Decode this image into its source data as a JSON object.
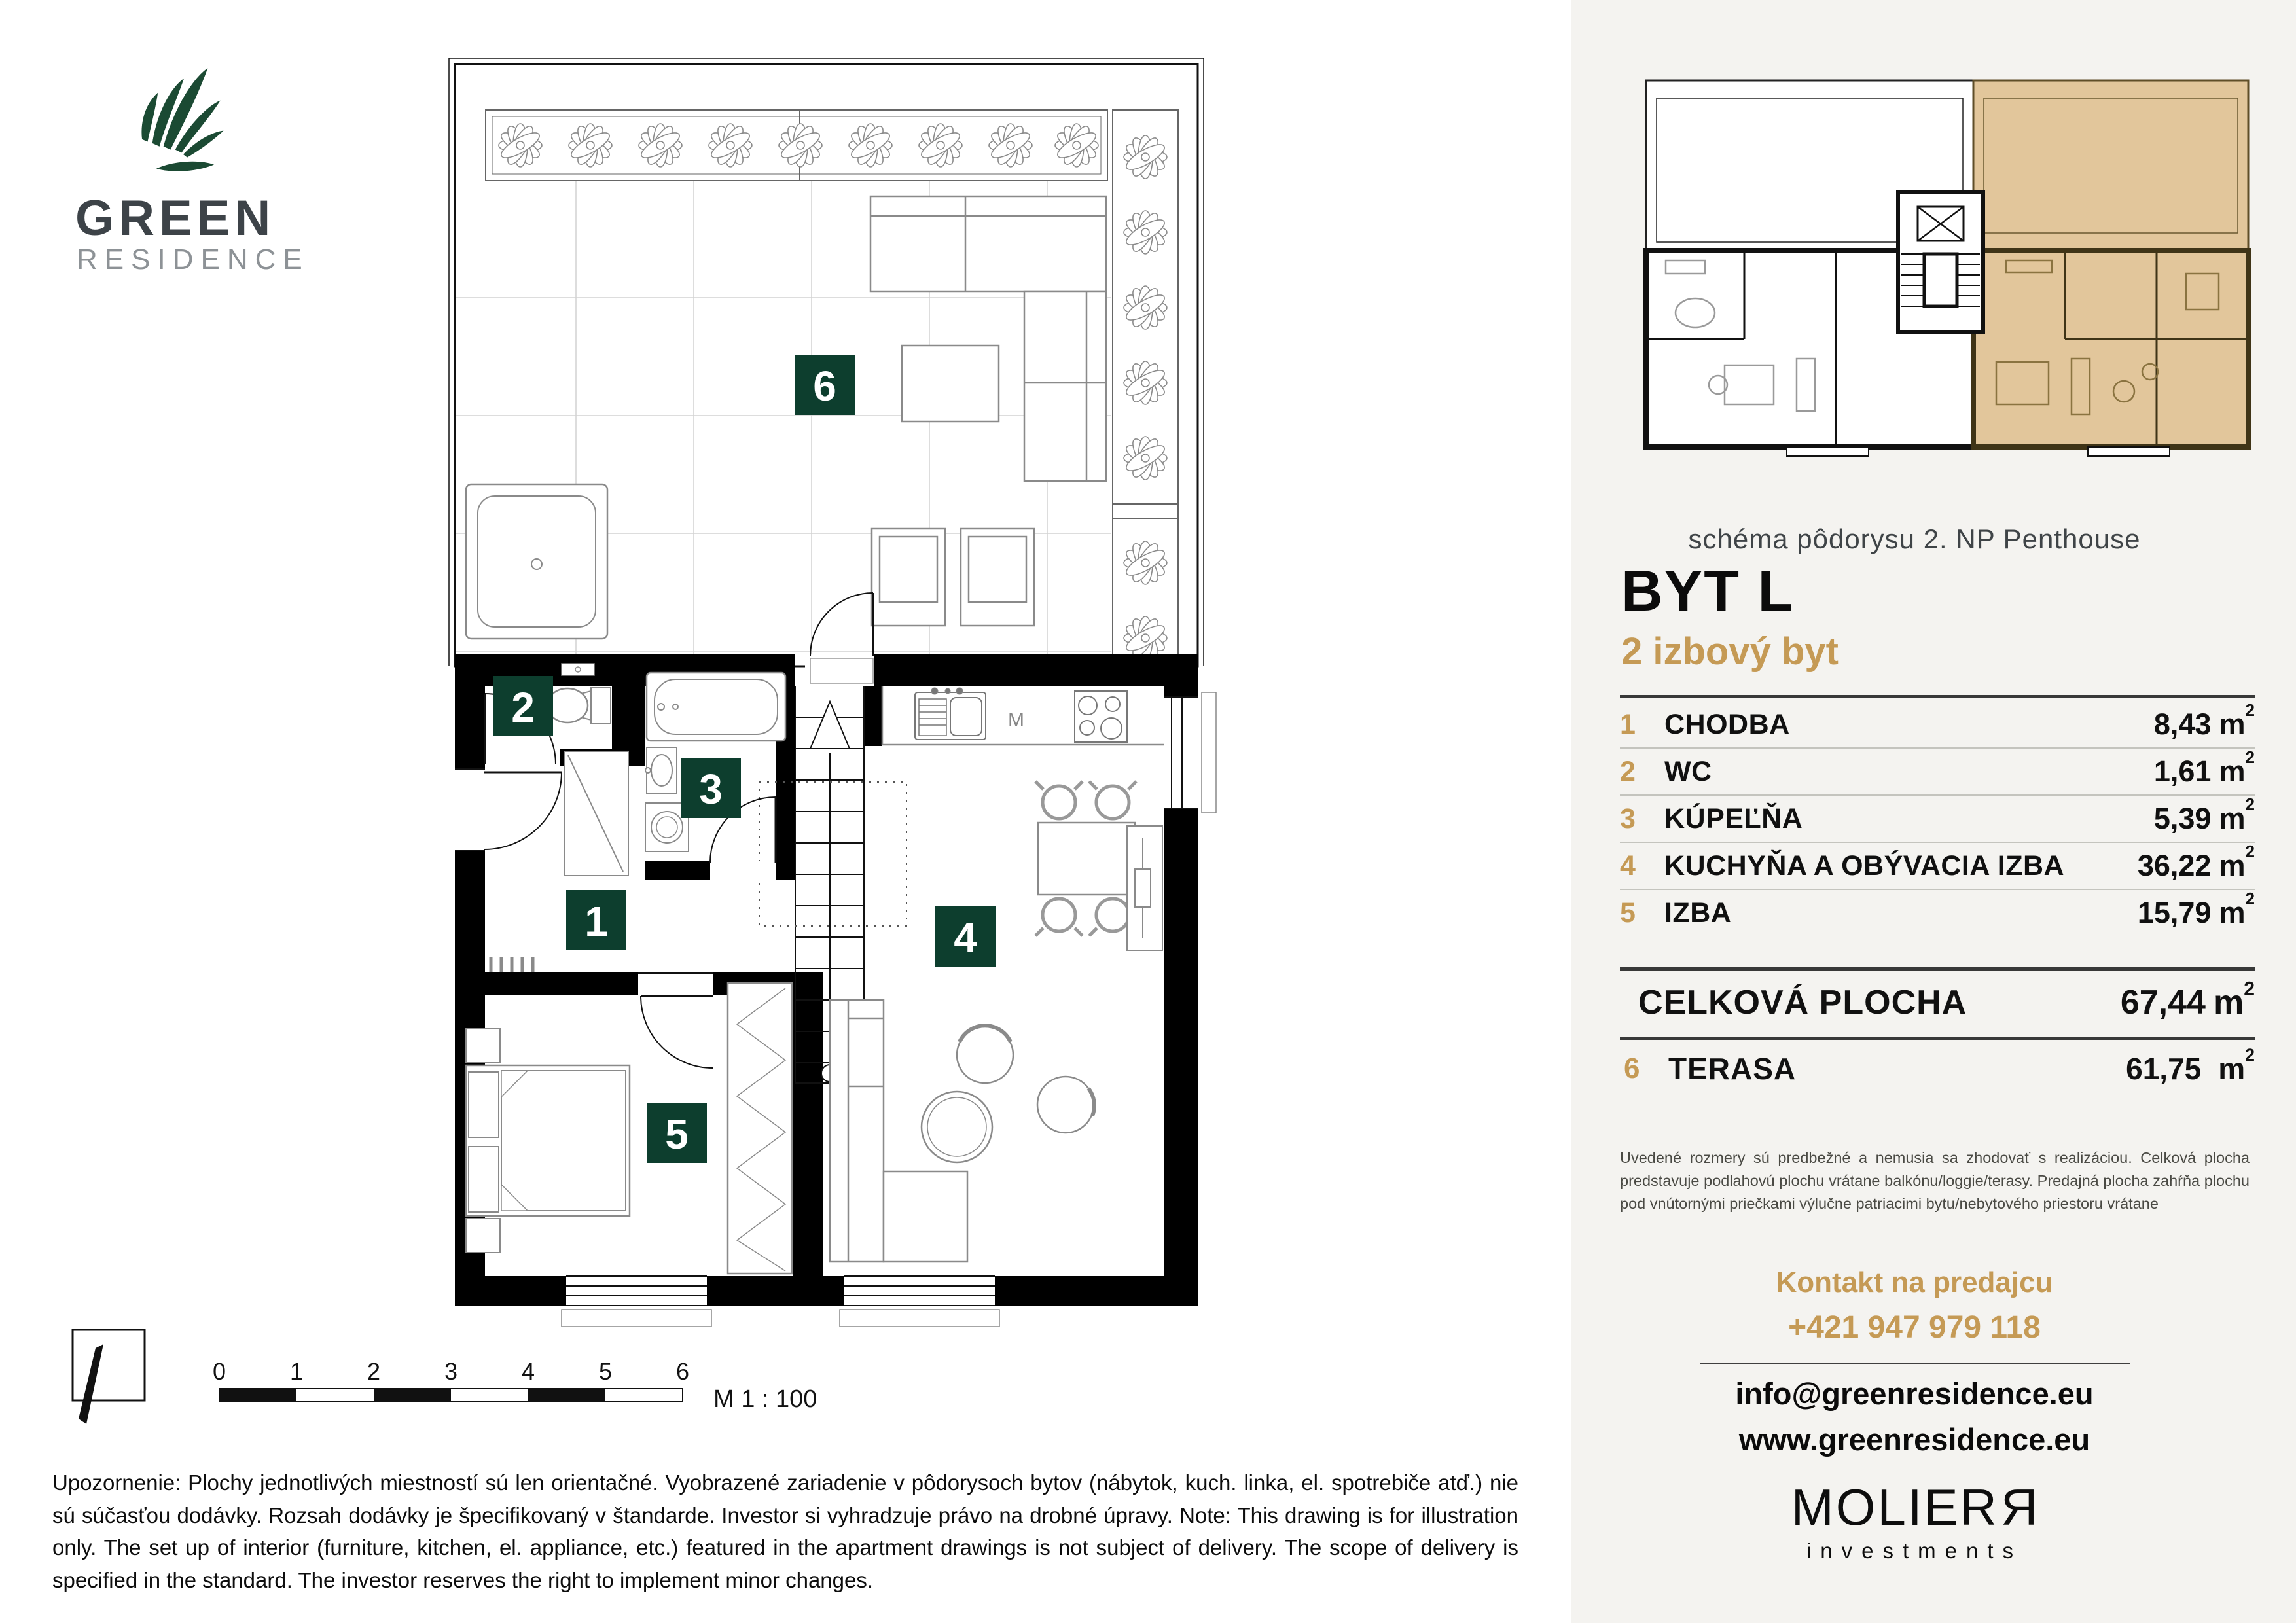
{
  "logo": {
    "line1": "GREEN",
    "line2": "RESIDENCE"
  },
  "minimap": {
    "caption": "schéma pôdorysu 2. NP Penthouse"
  },
  "unit": {
    "title": "BYT L",
    "subtitle": "2 izbový byt"
  },
  "legend": {
    "rooms": [
      {
        "no": "1",
        "label": "CHODBA",
        "value": "8,43"
      },
      {
        "no": "2",
        "label": "WC",
        "value": "1,61"
      },
      {
        "no": "3",
        "label": "KÚPEĽŇA",
        "value": "5,39"
      },
      {
        "no": "4",
        "label": "KUCHYŇA A OBÝVACIA IZBA",
        "value": "36,22"
      },
      {
        "no": "5",
        "label": "IZBA",
        "value": "15,79"
      }
    ],
    "total": {
      "label": "CELKOVÁ PLOCHA",
      "value": "67,44"
    },
    "terrace": {
      "no": "6",
      "label": "TERASA",
      "value": "61,75"
    },
    "unit_m": "m",
    "unit_sup": "2"
  },
  "note": "Uvedené rozmery sú predbežné a nemusia sa zhodovať s realizáciou. Celková plocha predstavuje podlahovú plochu vrátane balkónu/loggie/terasy. Predajná plocha zahŕňa plochu pod vnútornými priečkami výlučne patriacimi bytu/nebytového priestoru vrátane",
  "contact": {
    "heading": "Kontakt na predajcu",
    "phone": "+421 947 979 118",
    "email": "info@greenresidence.eu",
    "website": "www.greenresidence.eu"
  },
  "developer": {
    "name": "MOLIER",
    "flipped_letter": "R",
    "sub": "investments"
  },
  "plan": {
    "badges": [
      "1",
      "2",
      "3",
      "4",
      "5",
      "6"
    ],
    "kitchen_label": "M"
  },
  "scalebar": {
    "ticks": [
      "0",
      "1",
      "2",
      "3",
      "4",
      "5",
      "6"
    ],
    "label": "M 1 : 100"
  },
  "disclaimer": {
    "sk": "Upozornenie: Plochy jednotlivých miestností sú len orientačné. Vyobrazené zariadenie v pôdorysoch bytov (nábytok, kuch. linka, el. spotrebiče atď.) nie sú súčasťou dodávky. Rozsah dodávky je špecifikovaný v štandarde. Investor si vyhradzuje právo na drobné úpravy.",
    "en": "Note: This drawing is for illustration only. The set up of interior (furniture, kitchen, el. appliance, etc.) featured in the apartment drawings is not subject of delivery. The scope of delivery is specified in the standard. The investor reserves the right to implement minor changes."
  },
  "colors": {
    "badge_green": "#0d3e2e",
    "accent_gold": "#c59a55",
    "logo_green": "#1b4a33",
    "highlight_tan": "#e2c69b",
    "panel_bg": "#f4f3f0"
  }
}
